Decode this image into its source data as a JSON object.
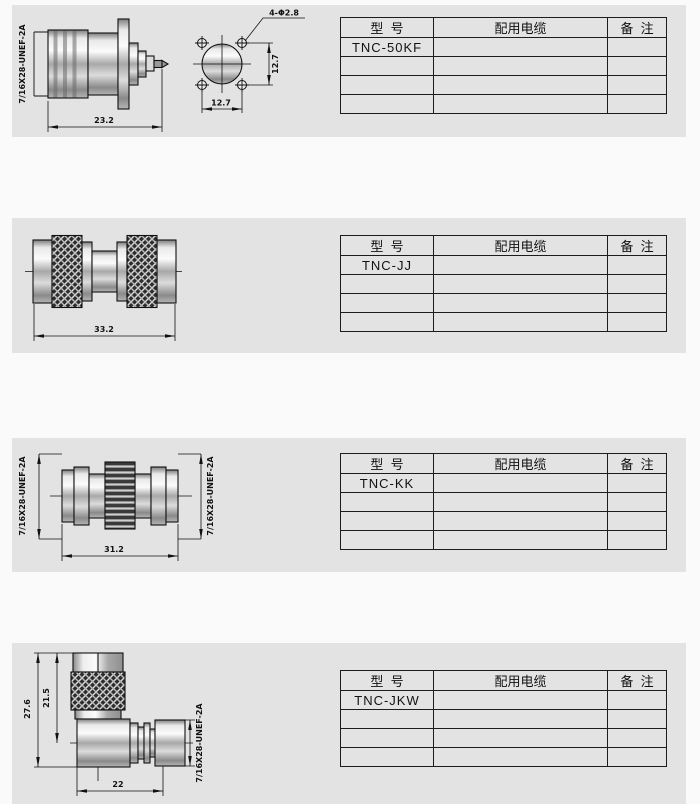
{
  "page": {
    "background": "#fafafa",
    "panel_background": "#e3e3e3",
    "line_color": "#111111"
  },
  "sections": [
    {
      "model": "TNC-50KF",
      "drawing": {
        "thread_label": "7/16X28-UNEF-2A",
        "overall_length": "23.2",
        "hole_callout": "4-Φ2.8",
        "hole_pitch_vertical": "12.7",
        "hole_pitch_horizontal": "12.7"
      },
      "table": {
        "headers": [
          "型  号",
          "配用电缆",
          "备  注"
        ],
        "rows": [
          [
            "TNC-50KF",
            "",
            ""
          ],
          [
            "",
            "",
            ""
          ],
          [
            "",
            "",
            ""
          ],
          [
            "",
            "",
            ""
          ]
        ]
      }
    },
    {
      "model": "TNC-JJ",
      "drawing": {
        "overall_length": "33.2"
      },
      "table": {
        "headers": [
          "型  号",
          "配用电缆",
          "备  注"
        ],
        "rows": [
          [
            "TNC-JJ",
            "",
            ""
          ],
          [
            "",
            "",
            ""
          ],
          [
            "",
            "",
            ""
          ],
          [
            "",
            "",
            ""
          ]
        ]
      }
    },
    {
      "model": "TNC-KK",
      "drawing": {
        "thread_label_left": "7/16X28-UNEF-2A",
        "thread_label_right": "7/16X28-UNEF-2A",
        "overall_length": "31.2"
      },
      "table": {
        "headers": [
          "型  号",
          "配用电缆",
          "备  注"
        ],
        "rows": [
          [
            "TNC-KK",
            "",
            ""
          ],
          [
            "",
            "",
            ""
          ],
          [
            "",
            "",
            ""
          ],
          [
            "",
            "",
            ""
          ]
        ]
      }
    },
    {
      "model": "TNC-JKW",
      "drawing": {
        "thread_label": "7/16X28-UNEF-2A",
        "overall_height": "27.6",
        "height_to_axis": "21.5",
        "overall_length": "22"
      },
      "table": {
        "headers": [
          "型  号",
          "配用电缆",
          "备  注"
        ],
        "rows": [
          [
            "TNC-JKW",
            "",
            ""
          ],
          [
            "",
            "",
            ""
          ],
          [
            "",
            "",
            ""
          ],
          [
            "",
            "",
            ""
          ]
        ]
      }
    }
  ]
}
